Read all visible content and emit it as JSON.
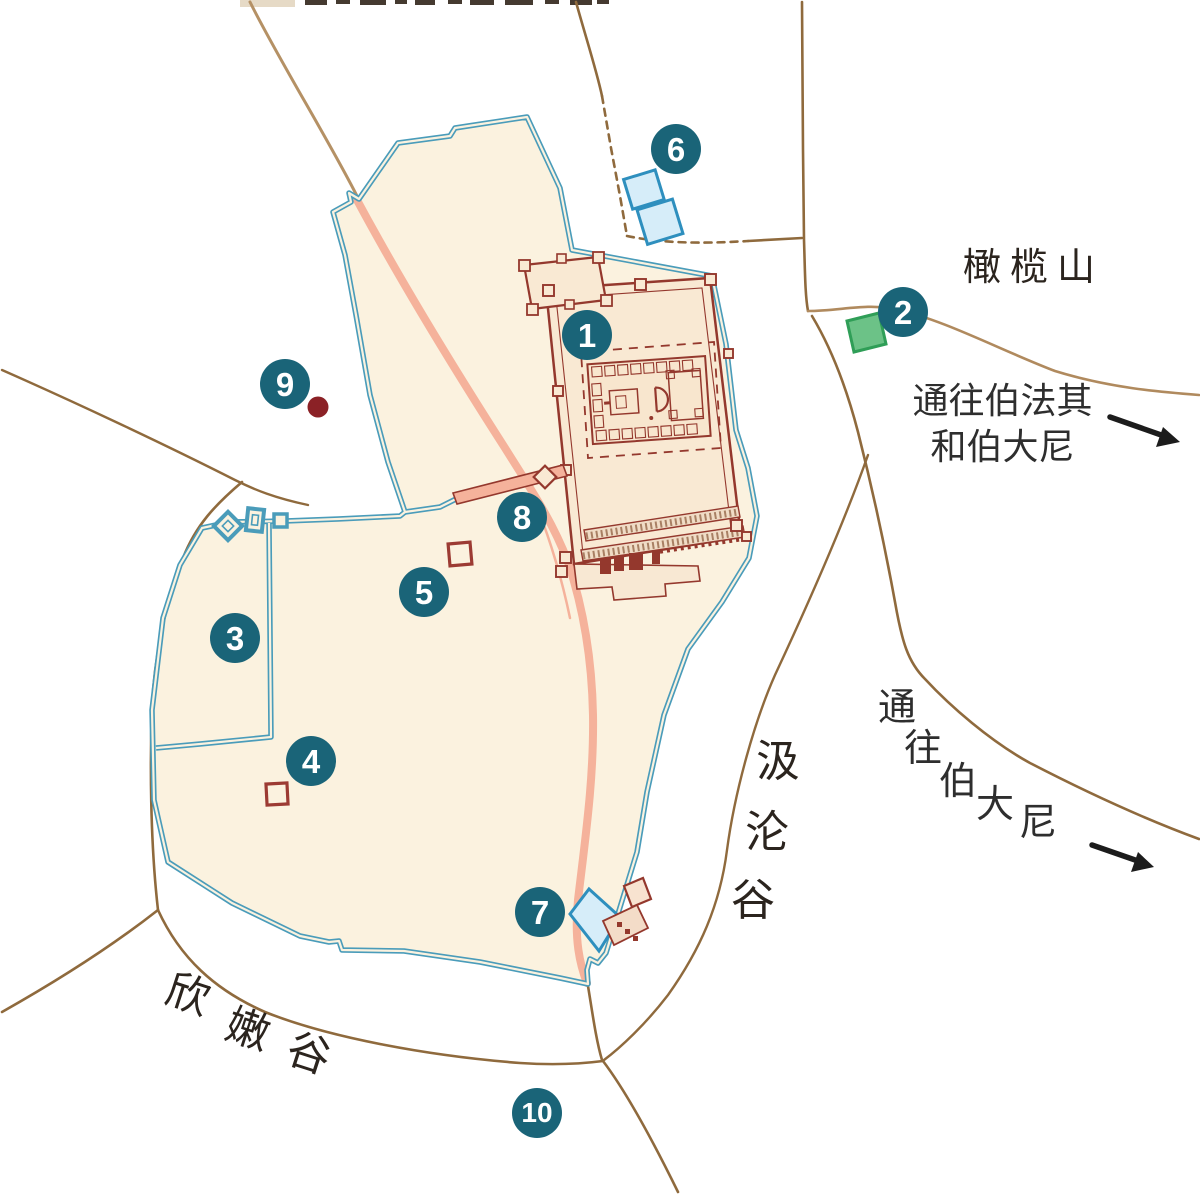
{
  "map": {
    "labels": {
      "mount_of_olives": "橄榄山",
      "to_bethphage_and_bethany": [
        "通往伯法其",
        "和伯大尼"
      ],
      "to_bethany_chars": [
        "通",
        "往",
        "伯",
        "大",
        "尼"
      ],
      "kidron_valley_chars": [
        "汲",
        "沦",
        "谷"
      ],
      "hinnom_valley_chars": [
        "欣",
        "嫩",
        "谷"
      ]
    },
    "markers": [
      {
        "n": "1"
      },
      {
        "n": "2"
      },
      {
        "n": "3"
      },
      {
        "n": "4"
      },
      {
        "n": "5"
      },
      {
        "n": "6"
      },
      {
        "n": "7"
      },
      {
        "n": "8"
      },
      {
        "n": "9"
      },
      {
        "n": "10"
      }
    ],
    "colors": {
      "marker_teal": "#1a6478",
      "wall_blue": "#4a9cba",
      "city_fill": "#fbf2df",
      "temple_red": "#94382d",
      "road_brown": "#8f6a3d",
      "road_light_brown": "#b59165",
      "street_salmon": "#f5b29b",
      "pool_fill": "#d6edf9",
      "pool_border": "#2e8fbe",
      "green_fill": "#6cc287",
      "green_border": "#2f9e57",
      "dot_dark_red": "#8b2126",
      "arrow_black": "#1c1c1c"
    }
  }
}
